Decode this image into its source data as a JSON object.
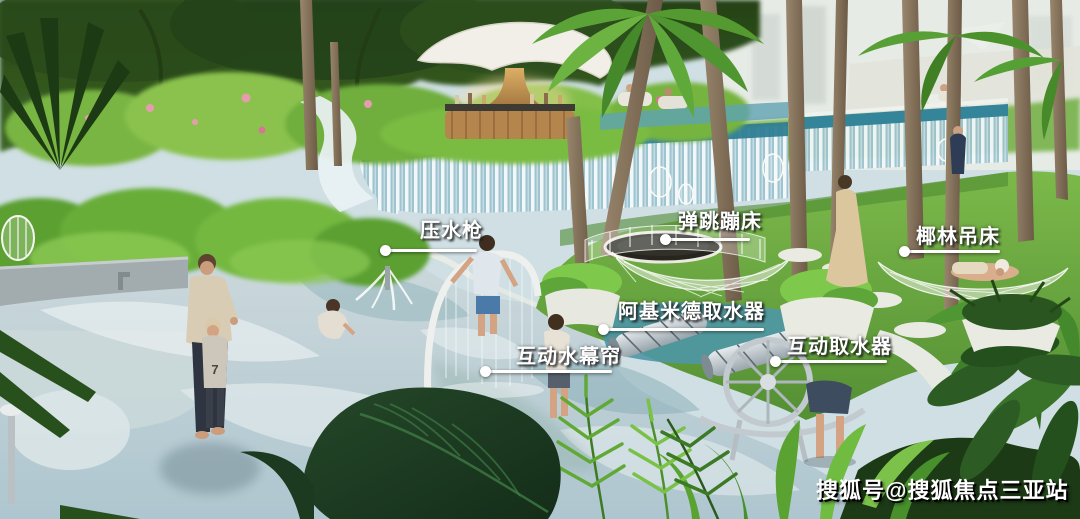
{
  "callouts": [
    {
      "id": "water-pressure-gun",
      "text": "压水枪"
    },
    {
      "id": "bounce-trampoline",
      "text": "弹跳蹦床"
    },
    {
      "id": "coconut-grove-hammock",
      "text": "椰林吊床"
    },
    {
      "id": "archimedes-water-collector",
      "text": "阿基米德取水器"
    },
    {
      "id": "interactive-water-curtain",
      "text": "互动水幕帘"
    },
    {
      "id": "interactive-water-collector",
      "text": "互动取水器"
    }
  ],
  "watermark": {
    "text": "搜狐号@搜狐焦点三亚站"
  },
  "scene": {
    "toddler_shirt_text": "7",
    "colors": {
      "pool_water": "#c6d9de",
      "pool_swirl": "#eef4f5",
      "waterfall_teal": "#2f7e93",
      "lawn_green": "#6fae43",
      "foliage_dark": "#2b481c",
      "foliage_bright": "#7cc24a",
      "palm_trunk": "#84705c",
      "pavilion_gold": "#c9994f",
      "label_text": "#ffffff"
    }
  }
}
